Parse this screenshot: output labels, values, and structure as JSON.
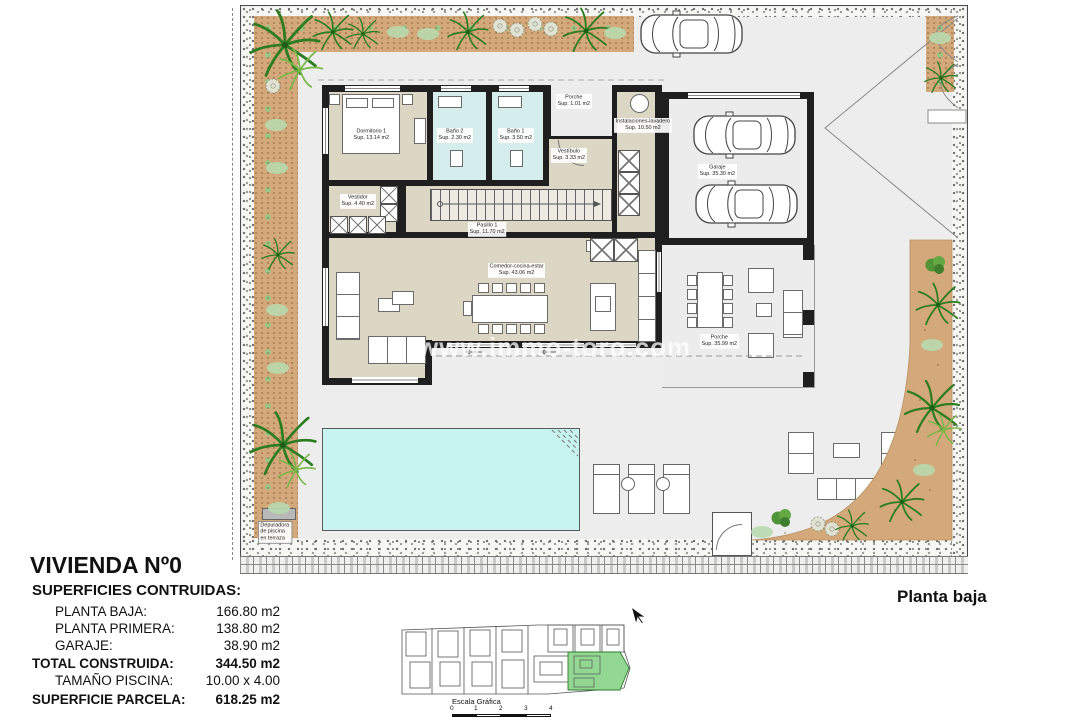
{
  "plan_label": "Planta baja",
  "watermark": "www.immo-toro.com",
  "title_block": {
    "title": "VIVIENDA Nº0",
    "subtitle": "SUPERFICIES CONTRUIDAS:",
    "rows": [
      {
        "label": "PLANTA BAJA:",
        "value": "166.80 m2"
      },
      {
        "label": "PLANTA PRIMERA:",
        "value": "138.80 m2"
      },
      {
        "label": "GARAJE:",
        "value": "38.90 m2"
      },
      {
        "label": "TOTAL CONSTRUIDA:",
        "value": "344.50 m2"
      },
      {
        "label": "TAMAÑO PISCINA:",
        "value": "10.00 x 4.00"
      },
      {
        "label": "SUPERFICIE PARCELA:",
        "value": "618.25 m2"
      }
    ]
  },
  "scale_bar": {
    "label": "Escala Gráfica",
    "ticks": [
      "0",
      "1",
      "2",
      "3",
      "4"
    ]
  },
  "rooms": {
    "dormitorio1": {
      "name": "Dormitorio 1",
      "area": "Sup. 13.14 m2"
    },
    "bano2": {
      "name": "Baño 2",
      "area": "Sup. 2.30 m2"
    },
    "bano1": {
      "name": "Baño 1",
      "area": "Sup. 3.50 m2"
    },
    "porche_entrada": {
      "name": "Porche",
      "area": "Sup. 1.01 m2"
    },
    "vestibulo": {
      "name": "Vestíbulo",
      "area": "Sup. 3.33 m2"
    },
    "lavadero": {
      "name": "Instalaciones-lavadero",
      "area": "Sup. 10.50 m2"
    },
    "garaje": {
      "name": "Garaje",
      "area": "Sup. 35.30 m2"
    },
    "vestidor": {
      "name": "Vestidor",
      "area": "Sup. 4.40 m2"
    },
    "pasillo1": {
      "name": "Pasillo 1",
      "area": "Sup. 11.70 m2"
    },
    "comedor": {
      "name": "Comedor-cocina-estar",
      "area": "Sup. 43.06 m2"
    },
    "porche_terraza": {
      "name": "Porche",
      "area": "Sup. 35.99 m2"
    },
    "depuradora": {
      "name": "Depuradora de piscina en terraza"
    }
  },
  "colors": {
    "interior_floor": "#dcd6c4",
    "bath_floor": "#d6edee",
    "pool": "#c7f4f0",
    "plot": "#ececec",
    "garden_bed": "#d3a97b",
    "wall": "#1f1f1f",
    "highlight_plot": "#92d892"
  }
}
